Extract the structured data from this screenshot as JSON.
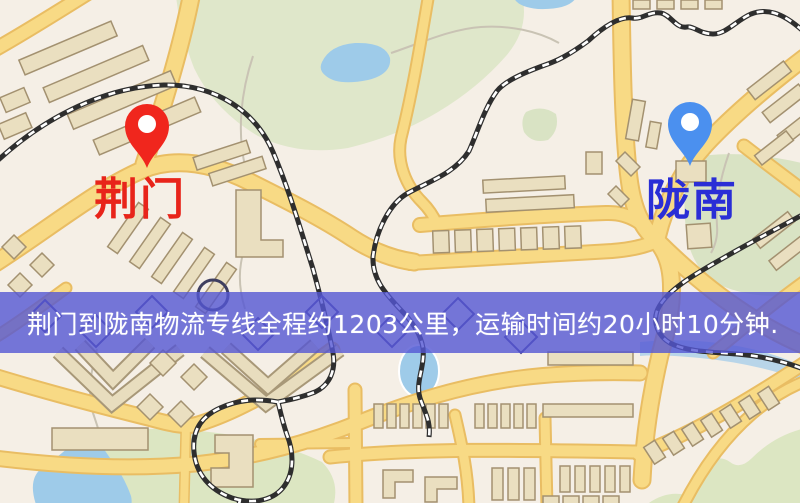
{
  "origin": {
    "label": "荆门",
    "marker_color": "#f0261d",
    "label_color": "#e8241a"
  },
  "destination": {
    "label": "陇南",
    "marker_color": "#4b90ef",
    "label_color": "#2a2ed6"
  },
  "banner": {
    "text": "荆门到陇南物流专线全程约1203公里，运输时间约20小时10分钟.",
    "distance_text": "约1203公里",
    "duration_text": "约20小时10分钟",
    "background_color": "#5456d3",
    "text_color": "#ffffff"
  },
  "map_colors": {
    "background": "#f5efe6",
    "road_fill": "#f8da85",
    "road_casing": "#e9bd63",
    "railway": "#2e2e2e",
    "park": "#dfe7ca",
    "water": "#9ecbe9",
    "building_fill": "#eadfc0",
    "building_stroke": "#a39170"
  }
}
